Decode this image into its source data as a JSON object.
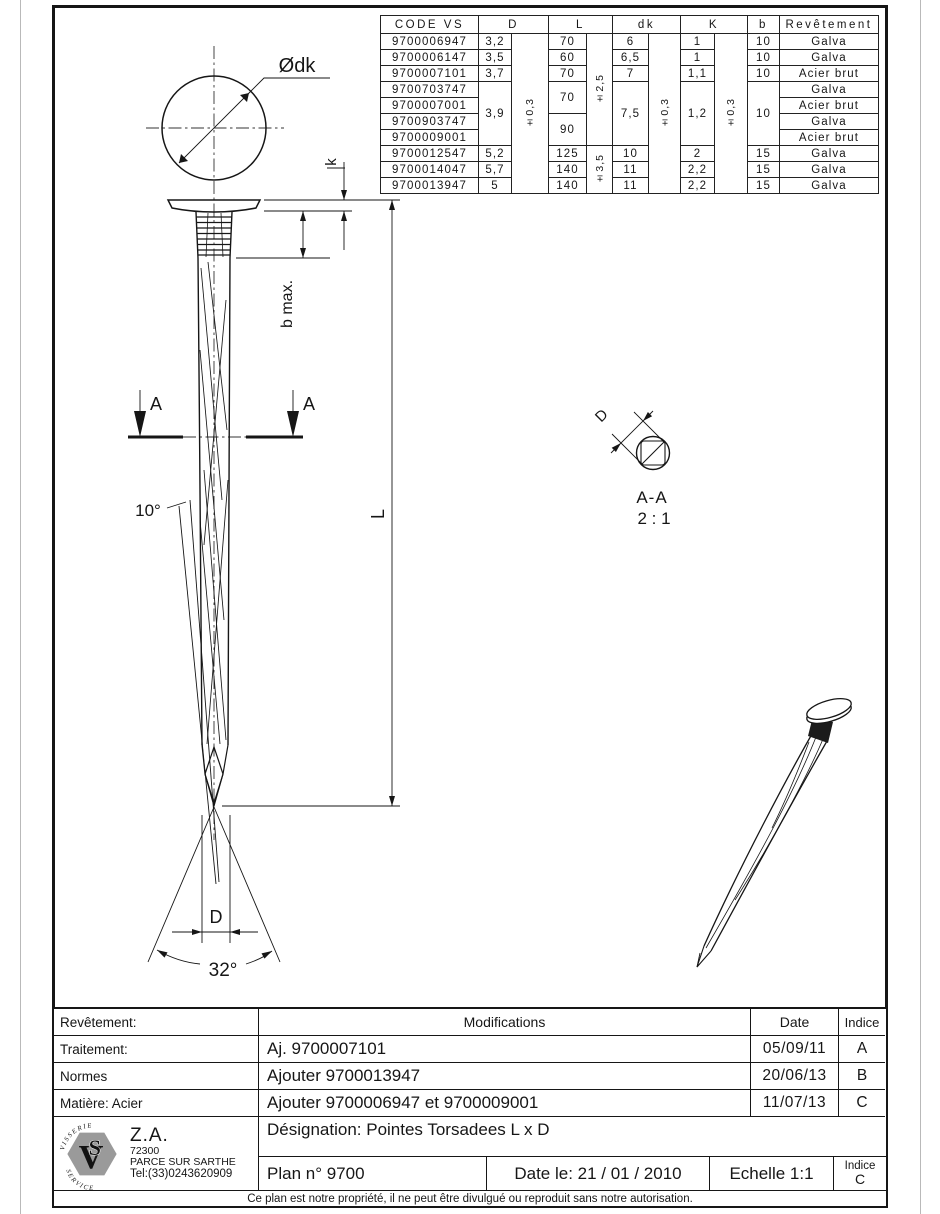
{
  "spec": {
    "headers": {
      "code": "CODE VS",
      "d": "D",
      "l": "L",
      "dk": "dk",
      "k": "K",
      "b": "b",
      "rev": "Revêtement"
    },
    "codes": [
      "9700006947",
      "9700006147",
      "9700007101",
      "9700703747",
      "9700007001",
      "9700903747",
      "9700009001",
      "9700012547",
      "9700014047",
      "9700013947"
    ],
    "d": {
      "r1": "3,2",
      "r2": "3,5",
      "r3": "3,7",
      "r4_7": "3,9",
      "r8": "5,2",
      "r9": "5,7",
      "r10": "5",
      "tol": "±0,3"
    },
    "l": {
      "r1": "70",
      "r2": "60",
      "r3": "70",
      "r4_5": "70",
      "r6_7": "90",
      "r8": "125",
      "r9": "140",
      "r10": "140",
      "tol_top": "±2,5",
      "tol_bottom": "±3,5"
    },
    "dk": {
      "r1": "6",
      "r2": "6,5",
      "r3": "7",
      "r4_7": "7,5",
      "r8": "10",
      "r9": "11",
      "r10": "11",
      "tol": "±0,3"
    },
    "k": {
      "r1": "1",
      "r2": "1",
      "r3": "1,1",
      "r4_7": "1,2",
      "r8": "2",
      "r9": "2,2",
      "r10": "2,2",
      "tol": "±0,3"
    },
    "b": {
      "r1": "10",
      "r2": "10",
      "r3": "10",
      "r4_7": "10",
      "r8": "15",
      "r9": "15",
      "r10": "15"
    },
    "rev": [
      "Galva",
      "Galva",
      "Acier brut",
      "Galva",
      "Acier brut",
      "Galva",
      "Acier brut",
      "Galva",
      "Galva",
      "Galva"
    ]
  },
  "drawing": {
    "head_diameter_label": "Ødk",
    "head_height_label": "k",
    "ring_length_label": "b max.",
    "section_mark_left": "A",
    "section_mark_right": "A",
    "twist_angle": "10°",
    "length_label": "L",
    "section_diameter_label": "D",
    "section_title": "A-A",
    "section_scale": "2 : 1",
    "point_diameter_label": "D",
    "point_angle": "32°"
  },
  "titleblock": {
    "revetement_label": "Revêtement:",
    "traitement_label": "Traitement:",
    "normes_label": "Normes",
    "matiere_label": "Matière: Acier",
    "modifications_header": "Modifications",
    "date_header": "Date",
    "indice_header": "Indice",
    "mods": [
      {
        "text": "Aj. 9700007101",
        "date": "05/09/11",
        "indice": "A"
      },
      {
        "text": "Ajouter 9700013947",
        "date": "20/06/13",
        "indice": "B"
      },
      {
        "text": "Ajouter 9700006947 et 9700009001",
        "date": "11/07/13",
        "indice": "C"
      }
    ],
    "designation": "Désignation: Pointes Torsadees L x D",
    "plan": "Plan n° 9700",
    "date_le": "Date le: 21 / 01 / 2010",
    "echelle": "Echelle 1:1",
    "indice_label": "Indice",
    "indice_value": "C",
    "company": {
      "za": "Z.A.",
      "cp": "72300",
      "city": "PARCE SUR SARTHE",
      "tel": "Tel:(33)0243620909",
      "logo_top": "V I S S E R I E",
      "logo_bottom": "S E R V I C E",
      "logo_v": "V",
      "logo_s": "S"
    },
    "footer": "Ce plan est notre propriété, il ne peut être divulgué ou reproduit sans notre autorisation."
  }
}
